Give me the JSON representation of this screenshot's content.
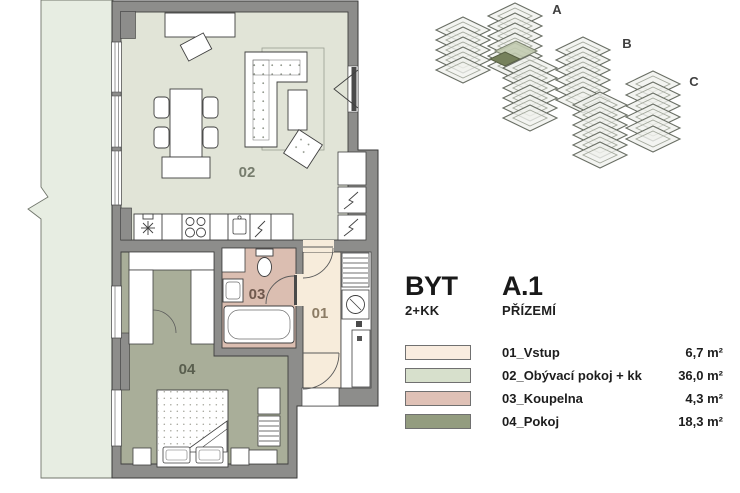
{
  "panel": {
    "title": "BYT",
    "layout": "2+KK",
    "unit": "A.1",
    "floor": "PŘÍZEMÍ",
    "legend": [
      {
        "label": "01_Vstup",
        "area": "6,7 m²",
        "color": "#f9ecdf"
      },
      {
        "label": "02_Obývací pokoj + kk",
        "area": "36,0 m²",
        "color": "#d7e0cc"
      },
      {
        "label": "03_Koupelna",
        "area": "4,3 m²",
        "color": "#dfc1b6"
      },
      {
        "label": "04_Pokoj",
        "area": "18,3 m²",
        "color": "#939c7f"
      }
    ]
  },
  "floorplan": {
    "rooms": [
      {
        "number": "01",
        "name": "Vstup"
      },
      {
        "number": "02",
        "name": "Obývací pokoj + kk"
      },
      {
        "number": "03",
        "name": "Koupelna"
      },
      {
        "number": "04",
        "name": "Pokoj"
      }
    ],
    "colors": {
      "wall": "#8d8d8b",
      "garden": "#e7ede2",
      "room01": "#f7ecdb",
      "room02": "#e1e4d7",
      "room03": "#dbbeb1",
      "room04": "#a9ae99"
    }
  },
  "site_diagram": {
    "buildings": [
      "A",
      "B",
      "C"
    ],
    "highlight_color": "#76815c"
  }
}
